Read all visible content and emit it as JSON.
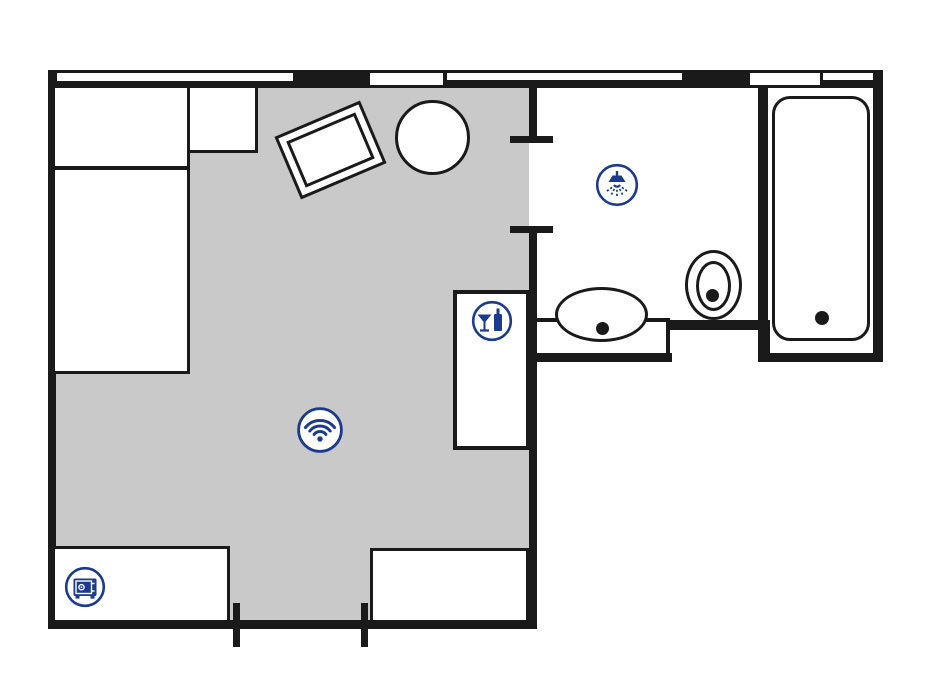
{
  "page": {
    "description": "Hotel room floor plan with bedroom-living area, bathroom and marked amenities",
    "text_labels": []
  },
  "colors": {
    "wall": "#1a1a1a",
    "carpet": "#c9c9c9",
    "accent": "#1c3a90",
    "floor": "#ffffff"
  },
  "rooms": [
    {
      "name": "bedroom-living-area",
      "floor_finish": "carpet-gray"
    },
    {
      "name": "bathroom",
      "floor_finish": "white"
    },
    {
      "name": "entry-corridor",
      "floor_finish": "carpet-gray"
    }
  ],
  "amenities": [
    {
      "label": "Shower",
      "icon": "shower-icon",
      "location": "bathroom"
    },
    {
      "label": "Minibar",
      "icon": "minibar-icon",
      "location": "minibar-cabinet"
    },
    {
      "label": "WiFi",
      "icon": "wifi-icon",
      "location": "bedroom-living-area"
    },
    {
      "label": "Safe",
      "icon": "safe-icon",
      "location": "left-wardrobe"
    }
  ],
  "furniture": {
    "bedroom": [
      "bed-with-pillow",
      "nightstand",
      "armchair",
      "round-table",
      "minibar-cabinet",
      "left-wardrobe",
      "right-wardrobe"
    ],
    "bathroom": [
      "vanity-counter",
      "sink",
      "toilet",
      "bathtub"
    ]
  },
  "openings": {
    "windows_top_wall": 5,
    "bathroom-door": "between bedroom and bathroom",
    "entry-door": "bottom wall between wardrobes"
  }
}
